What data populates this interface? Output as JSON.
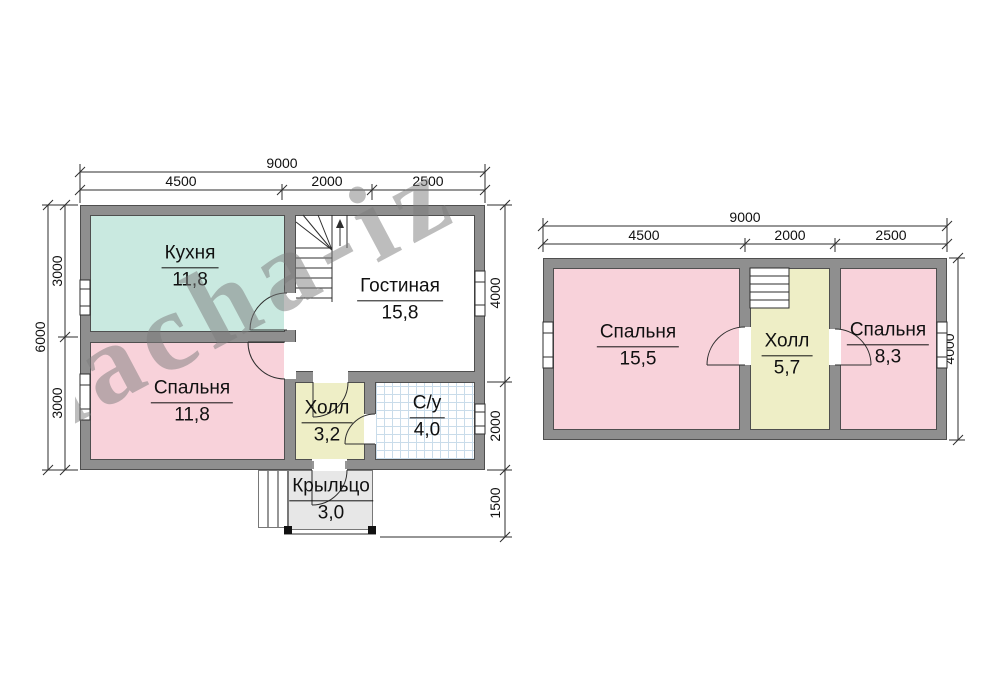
{
  "watermark": {
    "text": "dacha-iz"
  },
  "floor1": {
    "rooms": {
      "kitchen": {
        "name": "Кухня",
        "area": "11,8"
      },
      "living": {
        "name": "Гостиная",
        "area": "15,8"
      },
      "bedroom": {
        "name": "Спальня",
        "area": "11,8"
      },
      "hall": {
        "name": "Холл",
        "area": "3,2"
      },
      "bathroom": {
        "name": "С/у",
        "area": "4,0"
      },
      "porch": {
        "name": "Крыльцо",
        "area": "3,0"
      }
    },
    "dims": {
      "width_total": "9000",
      "width_left": "4500",
      "width_mid": "2000",
      "width_right": "2500",
      "height_total": "6000",
      "height_top": "3000",
      "height_bottom": "3000",
      "right_top": "4000",
      "right_mid": "2000",
      "right_bottom": "1500"
    }
  },
  "floor2": {
    "rooms": {
      "bedroom_left": {
        "name": "Спальня",
        "area": "15,5"
      },
      "hall": {
        "name": "Холл",
        "area": "5,7"
      },
      "bedroom_right": {
        "name": "Спальня",
        "area": "8,3"
      }
    },
    "dims": {
      "width_total": "9000",
      "width_left": "4500",
      "width_mid": "2000",
      "width_right": "2500",
      "height_total": "4000"
    }
  },
  "colors": {
    "wall": "#8f8f8f",
    "outline": "#4f4f4f",
    "kitchen": "#c9e9e0",
    "bedroom": "#f8d2da",
    "hall": "#eeeec6",
    "porch": "#e7e7e7",
    "tile": "#c9dcea",
    "line": "#2e2e2e",
    "watermark": "#7d7d7d"
  }
}
